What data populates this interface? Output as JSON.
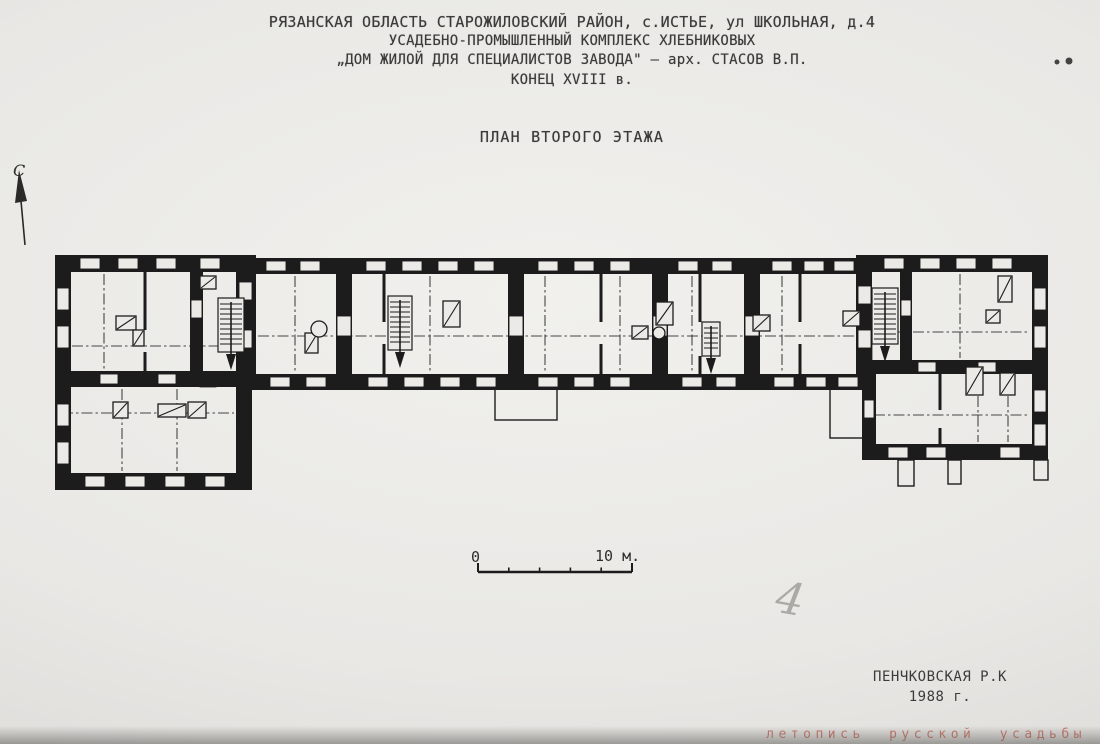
{
  "title_block": {
    "lines": [
      "РЯЗАНСКАЯ ОБЛАСТЬ  СТАРОЖИЛОВСКИЙ РАЙОН, с.ИСТЬЕ, ул ШКОЛЬНАЯ, д.4",
      "УСАДЕБНО-ПРОМЫШЛЕННЫЙ КОМПЛЕКС ХЛЕБНИКОВЫХ",
      "„ДОМ ЖИЛОЙ ДЛЯ СПЕЦИАЛИСТОВ ЗАВОДА\" — арх. СТАСОВ В.П.",
      "КОНЕЦ XVIII в."
    ]
  },
  "subtitle": "ПЛАН ВТОРОГО ЭТАЖА",
  "north": {
    "label": "С"
  },
  "scale_bar": {
    "start_label": "0",
    "end_label": "10 м.",
    "segments": 5
  },
  "handwritten": {
    "number": "4"
  },
  "credit": {
    "author": "ПЕНЧКОВСКАЯ Р.К",
    "year": "1988 г."
  },
  "watermark": {
    "text": "летопись русской усадьбы"
  },
  "colors": {
    "ink": "#1c1c1c",
    "paper": "#eceae7",
    "pencil": "#a9a7a3",
    "watermark": "#c4685a"
  },
  "plan": {
    "walls": [
      [
        55,
        255,
        197,
        17
      ],
      [
        55,
        255,
        16,
        235
      ],
      [
        55,
        473,
        197,
        17
      ],
      [
        236,
        255,
        20,
        135
      ],
      [
        236,
        387,
        16,
        103
      ],
      [
        55,
        371,
        197,
        16
      ],
      [
        190,
        272,
        13,
        99
      ],
      [
        252,
        258,
        612,
        16
      ],
      [
        252,
        374,
        612,
        16
      ],
      [
        336,
        274,
        16,
        100
      ],
      [
        508,
        274,
        16,
        100
      ],
      [
        652,
        274,
        16,
        100
      ],
      [
        744,
        274,
        16,
        100
      ],
      [
        856,
        255,
        16,
        135
      ],
      [
        862,
        255,
        186,
        17
      ],
      [
        1032,
        255,
        16,
        205
      ],
      [
        862,
        360,
        186,
        14
      ],
      [
        862,
        444,
        186,
        16
      ],
      [
        862,
        374,
        14,
        86
      ],
      [
        900,
        272,
        12,
        90
      ]
    ],
    "windows": [
      [
        80,
        258,
        20,
        11
      ],
      [
        118,
        258,
        20,
        11
      ],
      [
        156,
        258,
        20,
        11
      ],
      [
        200,
        258,
        20,
        11
      ],
      [
        266,
        261,
        20,
        10
      ],
      [
        300,
        261,
        20,
        10
      ],
      [
        366,
        261,
        20,
        10
      ],
      [
        402,
        261,
        20,
        10
      ],
      [
        438,
        261,
        20,
        10
      ],
      [
        474,
        261,
        20,
        10
      ],
      [
        538,
        261,
        20,
        10
      ],
      [
        574,
        261,
        20,
        10
      ],
      [
        610,
        261,
        20,
        10
      ],
      [
        678,
        261,
        20,
        10
      ],
      [
        712,
        261,
        20,
        10
      ],
      [
        772,
        261,
        20,
        10
      ],
      [
        804,
        261,
        20,
        10
      ],
      [
        834,
        261,
        20,
        10
      ],
      [
        884,
        258,
        20,
        11
      ],
      [
        920,
        258,
        20,
        11
      ],
      [
        956,
        258,
        20,
        11
      ],
      [
        992,
        258,
        20,
        11
      ],
      [
        57,
        288,
        12,
        22
      ],
      [
        57,
        326,
        12,
        22
      ],
      [
        57,
        404,
        12,
        22
      ],
      [
        57,
        442,
        12,
        22
      ],
      [
        85,
        476,
        20,
        11
      ],
      [
        125,
        476,
        20,
        11
      ],
      [
        165,
        476,
        20,
        11
      ],
      [
        205,
        476,
        20,
        11
      ],
      [
        100,
        374,
        18,
        10
      ],
      [
        158,
        374,
        18,
        10
      ],
      [
        239,
        282,
        13,
        18
      ],
      [
        239,
        330,
        13,
        18
      ],
      [
        270,
        377,
        20,
        10
      ],
      [
        306,
        377,
        20,
        10
      ],
      [
        368,
        377,
        20,
        10
      ],
      [
        404,
        377,
        20,
        10
      ],
      [
        440,
        377,
        20,
        10
      ],
      [
        476,
        377,
        20,
        10
      ],
      [
        538,
        377,
        20,
        10
      ],
      [
        574,
        377,
        20,
        10
      ],
      [
        610,
        377,
        20,
        10
      ],
      [
        682,
        377,
        20,
        10
      ],
      [
        716,
        377,
        20,
        10
      ],
      [
        774,
        377,
        20,
        10
      ],
      [
        806,
        377,
        20,
        10
      ],
      [
        838,
        377,
        20,
        10
      ],
      [
        337,
        316,
        14,
        20
      ],
      [
        509,
        316,
        14,
        20
      ],
      [
        653,
        316,
        14,
        20
      ],
      [
        745,
        316,
        14,
        20
      ],
      [
        858,
        286,
        13,
        18
      ],
      [
        858,
        330,
        13,
        18
      ],
      [
        191,
        300,
        11,
        18
      ],
      [
        901,
        300,
        10,
        16
      ],
      [
        1034,
        288,
        12,
        22
      ],
      [
        1034,
        326,
        12,
        22
      ],
      [
        1034,
        390,
        12,
        22
      ],
      [
        1034,
        424,
        12,
        22
      ],
      [
        918,
        362,
        18,
        10
      ],
      [
        978,
        362,
        18,
        10
      ],
      [
        888,
        447,
        20,
        11
      ],
      [
        926,
        447,
        20,
        11
      ],
      [
        1000,
        447,
        20,
        11
      ],
      [
        864,
        400,
        10,
        18
      ]
    ],
    "thin_walls": [
      [
        145,
        272,
        145,
        330
      ],
      [
        145,
        352,
        145,
        371
      ],
      [
        384,
        274,
        384,
        322
      ],
      [
        384,
        344,
        384,
        374
      ],
      [
        601,
        274,
        601,
        322
      ],
      [
        601,
        344,
        601,
        374
      ],
      [
        700,
        274,
        700,
        322
      ],
      [
        700,
        356,
        700,
        374
      ],
      [
        800,
        274,
        800,
        322
      ],
      [
        800,
        344,
        800,
        374
      ],
      [
        940,
        374,
        940,
        410
      ],
      [
        940,
        428,
        940,
        444
      ]
    ],
    "axis_lines": [
      [
        72,
        346,
        234,
        346
      ],
      [
        62,
        413,
        234,
        413
      ],
      [
        258,
        336,
        854,
        336
      ],
      [
        874,
        332,
        1030,
        332
      ],
      [
        874,
        415,
        1030,
        415
      ],
      [
        295,
        276,
        295,
        372
      ],
      [
        430,
        276,
        430,
        372
      ],
      [
        545,
        276,
        545,
        372
      ],
      [
        620,
        276,
        620,
        372
      ],
      [
        692,
        276,
        692,
        372
      ],
      [
        782,
        276,
        782,
        372
      ],
      [
        960,
        274,
        960,
        358
      ],
      [
        978,
        396,
        978,
        442
      ],
      [
        1008,
        396,
        1008,
        442
      ],
      [
        122,
        389,
        122,
        471
      ],
      [
        177,
        389,
        177,
        471
      ],
      [
        104,
        274,
        104,
        369
      ]
    ],
    "stairs": [
      [
        218,
        298,
        26,
        54
      ],
      [
        388,
        296,
        24,
        54
      ],
      [
        702,
        322,
        18,
        34
      ],
      [
        872,
        288,
        26,
        56
      ]
    ],
    "stoves_rect": [
      [
        116,
        316,
        20,
        14
      ],
      [
        133,
        330,
        11,
        16
      ],
      [
        200,
        276,
        16,
        13
      ],
      [
        113,
        402,
        15,
        16
      ],
      [
        158,
        404,
        28,
        13
      ],
      [
        188,
        402,
        18,
        16
      ],
      [
        305,
        333,
        13,
        20
      ],
      [
        443,
        301,
        17,
        26
      ],
      [
        632,
        326,
        16,
        13
      ],
      [
        656,
        302,
        17,
        23
      ],
      [
        753,
        315,
        17,
        16
      ],
      [
        843,
        311,
        17,
        15
      ],
      [
        998,
        276,
        14,
        26
      ],
      [
        986,
        310,
        14,
        13
      ],
      [
        966,
        367,
        17,
        28
      ],
      [
        1000,
        373,
        15,
        22
      ]
    ],
    "stoves_circle": [
      [
        319,
        329,
        8
      ],
      [
        659,
        333,
        6
      ]
    ],
    "porches": [
      [
        495,
        388,
        62,
        32
      ],
      [
        830,
        388,
        43,
        50
      ]
    ],
    "pillars": [
      [
        898,
        460,
        16,
        26
      ],
      [
        948,
        460,
        13,
        24
      ],
      [
        1034,
        460,
        14,
        20
      ]
    ],
    "hatches": [
      [
        200,
        372,
        16,
        15
      ],
      [
        354,
        375,
        14,
        14
      ],
      [
        594,
        375,
        16,
        14
      ],
      [
        794,
        375,
        12,
        14
      ],
      [
        962,
        445,
        19,
        14
      ],
      [
        858,
        344,
        14,
        16
      ]
    ],
    "specks": [
      [
        1057,
        62,
        2.5
      ],
      [
        1069,
        61,
        3.5
      ]
    ]
  }
}
